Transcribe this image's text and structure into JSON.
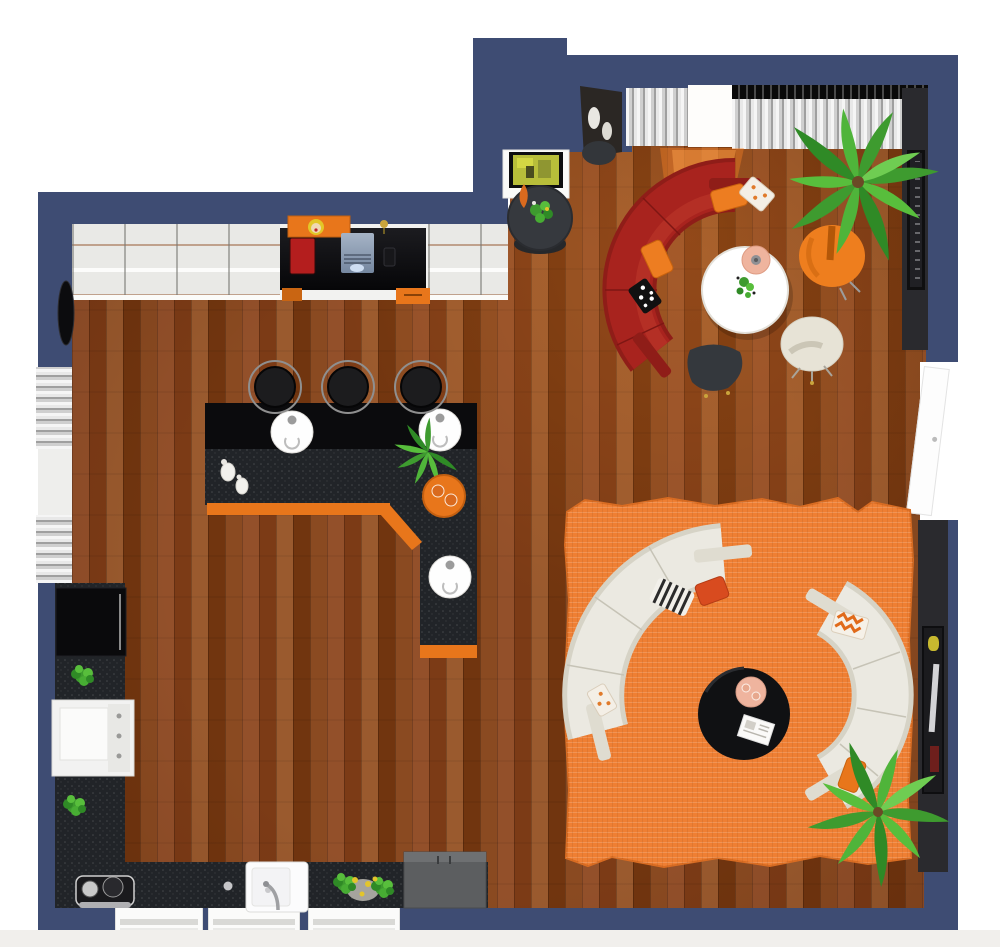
{
  "meta": {
    "scene": "3d-floor-plan",
    "view": "top-down",
    "areas": [
      "living-area",
      "lounge",
      "bar",
      "kitchen",
      "work-desk"
    ]
  },
  "colors": {
    "wall": "#3E4C73",
    "wall_inner_dark": "#2A2A2E",
    "outside": "#FFFFFF",
    "floor_wood": "#8A4A21",
    "rug": "#EF7F33",
    "rug_edge": "#D96C22",
    "sofa_red": "#A8231E",
    "sofa_red_dark": "#8F1D18",
    "sofa_white": "#EBE9E1",
    "sofa_white_edge": "#D6D3C6",
    "chair_orange": "#EE7E1E",
    "chair_cream": "#E7E3D6",
    "accent_orange": "#E8761B",
    "pillow_orange": "#ED7D21",
    "pillow_red_orange": "#D84B1F",
    "counter_dark": "#212428",
    "bar_top_black": "#0B0B0D",
    "stool_black": "#1C1C1E",
    "table_white": "#FFFFFF",
    "table_black": "#101113",
    "table_charcoal": "#36393E",
    "side_table_dark": "#34383D",
    "lamp_peach": "#EFB49E",
    "curtain_light": "#E2E2E2",
    "curtain_rail_dark": "#141414",
    "plant_green": "#3E9B2F",
    "plant_green_light": "#58BE3C",
    "stove_white": "#F2F2F1",
    "fridge_black": "#0A0A0C",
    "cabinet_gray": "#5C5E60",
    "tv_screen": "#B8BE3A",
    "sun_light": "#FF8426",
    "door_white": "#FDFDFD",
    "window_glass": "#E9E9E6"
  },
  "inventory": [
    {
      "item": "curved-sectional-sofa",
      "color": "red",
      "count": 1
    },
    {
      "item": "curved-sectional-sofa",
      "color": "white",
      "count": 2
    },
    {
      "item": "round-coffee-table",
      "color": "white",
      "count": 1
    },
    {
      "item": "round-coffee-table",
      "color": "black",
      "count": 1
    },
    {
      "item": "round-console-table",
      "color": "charcoal",
      "count": 1
    },
    {
      "item": "swivel-armchair",
      "color": "orange",
      "count": 1
    },
    {
      "item": "swivel-armchair",
      "color": "cream",
      "count": 1
    },
    {
      "item": "triangular-side-table",
      "color": "black",
      "count": 1
    },
    {
      "item": "area-rug",
      "color": "orange",
      "count": 1
    },
    {
      "item": "l-shaped-bar-counter",
      "color": "black-orange",
      "count": 1
    },
    {
      "item": "bar-stool",
      "color": "black",
      "count": 3
    },
    {
      "item": "round-bar-sink",
      "color": "white",
      "count": 3
    },
    {
      "item": "serving-tray",
      "color": "orange",
      "count": 1
    },
    {
      "item": "decanter",
      "color": "white",
      "count": 2
    },
    {
      "item": "desk",
      "color": "black-orange",
      "count": 1
    },
    {
      "item": "laptop",
      "count": 1
    },
    {
      "item": "red-book",
      "count": 1
    },
    {
      "item": "pop-art-wall-picture",
      "count": 1
    },
    {
      "item": "tv",
      "count": 1
    },
    {
      "item": "corner-display-shelf",
      "count": 1
    },
    {
      "item": "decorative-vase",
      "color": "white",
      "count": 2
    },
    {
      "item": "palm-plant",
      "count": 2
    },
    {
      "item": "potted-plant",
      "count": 4
    },
    {
      "item": "flower-pot",
      "color": "yellow-flowers",
      "count": 1
    },
    {
      "item": "refrigerator",
      "color": "black",
      "count": 1
    },
    {
      "item": "cooktop",
      "color": "white",
      "count": 1
    },
    {
      "item": "kitchen-sink",
      "color": "white",
      "count": 1
    },
    {
      "item": "espresso-machine",
      "count": 1
    },
    {
      "item": "base-cabinet",
      "color": "gray",
      "count": 1
    },
    {
      "item": "framed-artwork",
      "count": 2
    },
    {
      "item": "wall-mirror",
      "color": "black",
      "count": 1
    },
    {
      "item": "table-lamp",
      "color": "peach",
      "count": 1
    },
    {
      "item": "throw-pillow",
      "count": 8
    },
    {
      "item": "window",
      "count": 7
    },
    {
      "item": "door",
      "count": 2
    }
  ]
}
